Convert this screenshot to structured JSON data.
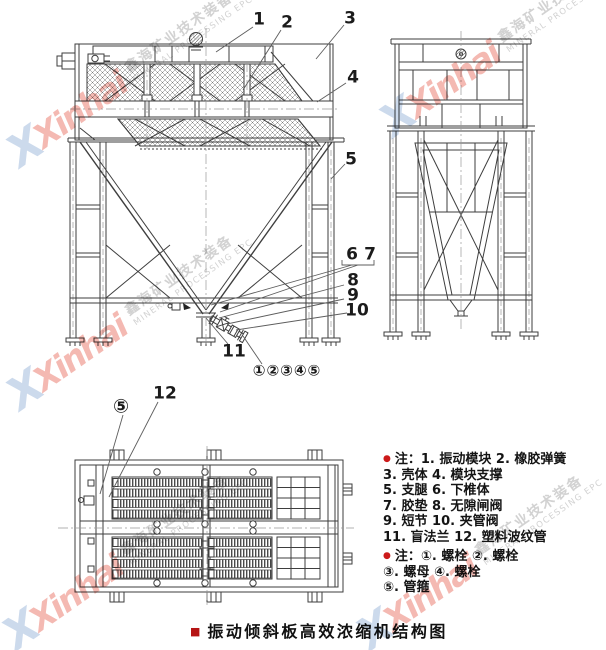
{
  "title_block": {
    "bullet": "■",
    "text": "振动倾斜板高效浓缩机结构图"
  },
  "watermark": {
    "x_glyph": "X",
    "brand": "Xinhai",
    "cn": "鑫海矿业技术装备",
    "en": "MINERAL PROCESSING EPC"
  },
  "notes": {
    "bullet": "●",
    "block1": [
      "注：1. 振动模块 2. 橡胶弹簧",
      "3. 壳体 4. 模块支撑",
      "5. 支腿 6. 下椎体",
      "7. 胶垫 8. 无隙闸阀",
      "9. 短节 10. 夹管阀",
      "11. 盲法兰 12. 塑料波纹管"
    ],
    "block2": [
      "注：①. 螺栓 ②. 螺栓",
      "③. 螺母 ④. 螺栓",
      "⑤. 管箍"
    ]
  },
  "callouts": {
    "front": {
      "n1": "1",
      "n2": "2",
      "n3": "3",
      "n4": "4",
      "n5": "5",
      "n6": "6",
      "n7": "7",
      "n8": "8",
      "n9": "9",
      "n10": "10",
      "n11": "11",
      "circled_row": "①②③④⑤"
    },
    "plan": {
      "circled5": "⑤",
      "n12": "12"
    }
  },
  "colors": {
    "line": "#3e3e3e",
    "accent_red": "#bb1717",
    "watermark_pink": "#f4b9b2",
    "watermark_blue": "#ccdaec",
    "watermark_gray": "#d2d2d2"
  }
}
